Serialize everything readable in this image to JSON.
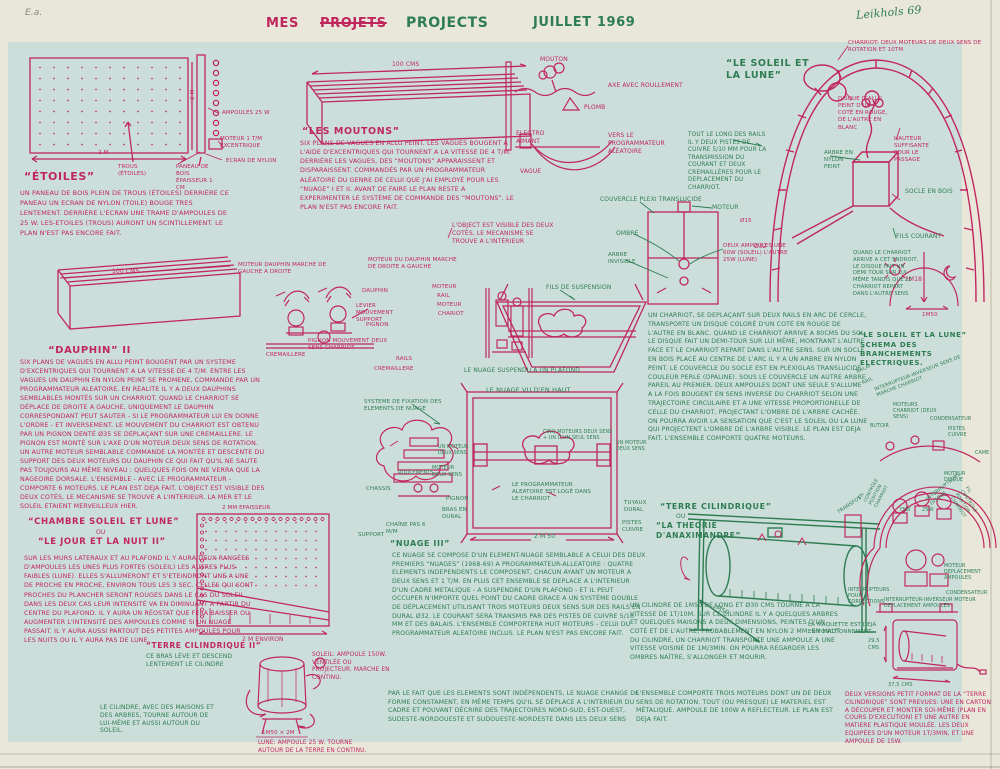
{
  "colors": {
    "red": "#c0275e",
    "green": "#2e7d52",
    "paper": "#e9e6da",
    "field": "#ccdeda"
  },
  "hdr": {
    "ea": "E.a.",
    "mes": "MES",
    "projets": "PROJETS",
    "projects": "PROJECTS",
    "date": "JUILLET 1969",
    "sig": "Leikhols 69"
  },
  "et": {
    "t": "“ÉTOILES”",
    "w": "2 M",
    "h": "2 M",
    "trous": "TROUS (ÉTOILES)",
    "amp": "AMPOULES 25 W",
    "mot": "MOTEUR 1 T/M EXCENTRIQUE",
    "ecr": "ECRAN DE NYLON",
    "pan": "PANEAU DE BOIS ÉPAISSEUR 1 CM",
    "b": "UN PANEAU DE BOIS PLEIN DE TROUS (ÉTOILES) DERRIÈRE CE PANEAU UN ECRAN DE NYLON (TOILE) BOUGE TRES LENTEMENT. DERRIÈRE L'ECRAN UNE TRAME D'AMPOULES DE 25 W. LES-ETOILES (TROUS) AURONT UN SCINTILLEMENT. LE PLAN N'EST PAS ENCORE FAIT."
  },
  "mo": {
    "dim": "100 CMS",
    "t": "“LES MOUTONS”",
    "b": "SIX PLANS DE VAGUES EN ALLU PEINT. LES VAGUES BOUGENT A L'AIDE D'EXCENTRIQUES QUI TOURNENT A LA VITESSE DE 4 T/M. DERRIÈRE LES VAGUES, DES “MOUTONS” APPARAISSENT ET DISPARAISSENT. COMMANDÉS PAR UN PROGRAMMATEUR ALÉATOIRE DU GENRE DE CELUI QUE J'AI EMPLOYÉ POUR LES “NUAGE” I ET II. AVANT DE FAIRE LE PLAN RESTE A EXPERIMENTER LE SYSTÈME DE COMMANDE DES “MOUTONS”. LE PLAN N'EST PAS ENCORE FAIT.",
    "n": "L'OBJECT EST VISIBLE DES DEUX COTÉS, LE MECANISME SE TROUVE A L'INTÉRIEUR"
  },
  "ms": {
    "mouton": "MOUTON",
    "axe": "AXE AVEC ROULLEMENT",
    "plomb": "PLOMB",
    "ea": "ELECTRO AIMANT",
    "vague": "VAGUE",
    "vers": "VERS LE PROGRAMMATEUR ALÉATOIRE"
  },
  "sl": {
    "t": "“LE SOLEIL ET LA LUNE”",
    "char": "CHARRIOT: DEUX MOTEURS DE DEUX SENS DE ROTATION ET 10TM",
    "disq": "DISQUE D'ALLU PEINT D'UN COTÉ EN ROUGE, DE L'AUTRE EN BLANC",
    "haut": "HAUTEUR SUFFISANTE POUR LE PASSAGE",
    "arbre": "ARBRE EN NYLON PEINT",
    "socle": "SOCLE EN BOIS",
    "fils": "FILS COURANT",
    "d1": "Ø15",
    "d2": "Ø32",
    "h": "2M18",
    "w": "1M50",
    "rails": "TOUT LE LONG DES RAILS IL Y DEUX PISTES DE CUIVRE 5/10 MM POUR LA TRANSMISSION DU COURANT ET DEUX CREMAILLÈRES POUR LE DEPLACEMENT DU CHARRIOT.",
    "quand": "QUAND LE CHARRIOT ARRIVE A CET ENDROIT, LE DISQUE FAIT UN DEMI TOUR SUR LUI-MÊME TANDIS QUE LE CHARRIOT REPART DANS L'AUTRE SENS"
  },
  "cv": {
    "couv": "COUVERCLE PLEXI TRANSLUCIDE",
    "mot": "MOTEUR",
    "omb": "OMBRE",
    "arb": "ARBRE INVISIBLE",
    "amp": "DEUX AMPOULES UNE 60W (SOLEIL) L'AUTRE 25W (LUNE)"
  },
  "da": {
    "dim": "100 CMS",
    "mg": "MOTEUR DAUPHIN MARCHE DE GAUCHE A DROITE",
    "md": "MOTEUR DU DAUPHIN MARCHE DE DROITE A GAUCHE",
    "t": "“DAUPHIN” II",
    "b": "SIX PLANS DE VAGUES EN ALLU PEINT BOUGENT PAR UN SYSTEME D'EXCENTRIQUES QUI TOURNENT A LA VITESSE DE 4 T/M. ENTRE LES VAGUES UN DAUPHIN EN NYLON PEINT SE PROMENE, COMMANDE PAR UN PROGRAMMATEUR ALEATOIRE. EN REALITE IL Y A DEUX DAUPHINS SEMBLABLES MONTÉS SUR UN CHARRIOT. QUAND LE CHARRIOT SE DÉPLACE DE DROITE A GAUCHE, UNIQUEMENT LE DAUPHIN CORRESPONDANT PEUT SAUTER - SI LE PROGRAMMATEUR LUI EN DONNE L'ORDRE - ET INVERSEMENT. LE MOUVEMENT DU CHARRIOT EST OBTENU PAR UN PIGNON DENTÉ Ø35 SE DÉPLAÇANT SUR UNE CREMAILLERE. LE PIGNON EST MONTÉ SUR L'AXE D'UN MOTEUR DEUX SENS DE ROTATION. UN AUTRE MOTEUR SEMBLABLE COMMANDE LA MONTÉE ET DESCENTE DU SUPPORT DES DEUX MOTEURS DU DAUPHIN CE QUI FAIT QU'IL NE SAUTE PAS TOUJOURS AU MÊME NIVEAU : QUELQUES FOIS ON NE VERRA QUE LA NAGEOIRE DORSALE. L'ENSEMBLE - AVEC LE PROGRAMMATEUR - COMPORTE 6 MOTEURS. LE PLAN EST DEJA FAIT. L'OBJECT EST VISIBLE DES DEUX COTÉS, LE MECANISME SE TROUVE A L'INTERIEUR. LA MER ET LE SOLEIL ETAIENT MERVEILLEUX HIER."
  },
  "dk": {
    "dauphin": "DAUPHIN",
    "m1": "MOTEUR",
    "rail": "RAIL",
    "m2": "MOTEUR",
    "chariot": "CHARIOT",
    "levier": "LEVIER MOUVEMENT SUPPORT",
    "pignon": "PIGNON",
    "pmc": "PIGNON MOUVEMENT DEUX SENS CHARRIOT",
    "crem1": "CREMAILLERE",
    "rails": "RAILS",
    "crem2": "CREMAILLERE"
  },
  "nu": {
    "fils": "FILS DE SUSPENSION",
    "plafond": "LE NUAGE SUSPENDU A UN PLAFOND",
    "haut": "LE NUAGE VU D'EN HAUT",
    "sys": "SYSTEME DE FIXATION DES ELEMENTS DE NUAGE",
    "m1": "UN MOTEUR DEUX SENS",
    "cinq": "CINQ MOTEURS DEUX SENS + UN D'UN SEUL SENS",
    "m2": "UN MOTEUR DEUX SENS",
    "roul": "ROULEMENTS",
    "mds": "MOTEUR DEUX SENS",
    "pig": "PIGNON",
    "bras": "BRAS EN DURAL",
    "chaine": "CHAÎNE PAS 6 M/M",
    "chassis": "CHASSIS",
    "support": "SUPPORT",
    "prog": "LE PROGRAMMATEUR ALEATOIRE EST LOGÉ DANS LE CHARRIOT",
    "tuy": "TUYAUX DURAL",
    "pistes": "PISTES CUIVRE",
    "dim": "2 M 50"
  },
  "arc": {
    "b": "UN CHARRIOT, SE DEPLAÇANT SUR DEUX RAILS EN ARC DE CERCLE, TRANSPORTE UN DISQUE COLORÉ D'UN COTÉ EN ROUGE DE L'AUTRE EN BLANC. QUAND LE CHARRIOT ARRIVE A 80CMS DU SOL, LE DISQUE FAIT UN DEMI-TOUR SUR LUI MÊME, MONTRANT L'AUTRE FACE ET LE CHARRIOT REPART DANS L'AUTRE SENS. SUR UN SOCLE EN BOIS PLACÉ AU CENTRE DE L'ARC IL Y A UN ARBRE EN NYLON PEINT. LE COUVERCLE DU SOCLE EST EN PLEXIGLAS TRANSLUCIDE COULEUR PERLE (OPALINE). SOUS LE COUVERCLE UN AUTRE ARBRE PAREIL AU PREMIER. DEUX AMPOULES DONT UNE SEULE S'ALLUME A LA FOIS BOUGENT EN SENS INVERSE DU CHARRIOT SELON UNE TRAJECTOIRE CIRCULAIRE ET A UNE VITESSE PROPORTIONELLE DE CELLE DU CHARRIOT, PROJECTANT L'OMBRE DE L'ARBRE CACHÉE. ON POURRA AVOIR LA SENSATION QUE C'EST LE SOLEIL OU LA LUNE QUI PROJECTENT L'OMBRE DE L'ARBRE VISIBLE. LE PLAN EST DEJA FAIT. L'ENSEMBLE COMPORTE QUATRE MOTEURS."
  },
  "sch": {
    "t1": "“LE SOLEIL ET LA LUNE”",
    "t2": "SCHEMA DES BRANCHEMENTS ELECTRIQUES.",
    "balai": "BALAI",
    "rail": "RAIL",
    "inv": "INTERRUPTEUR-INVERSEUR SENS DE MARCHE CHARRIOT",
    "motc": "MOTEURS CHARRIOT (DEUX SENS)",
    "but": "BUTOIR",
    "cond": "CONDENSATEUR",
    "pistes": "PISTES CUIVRE",
    "came": "CAME",
    "motd": "MOTEUR DISQUE",
    "intd": "INTERRUPTEURS DISQUE",
    "w75": "75W",
    "w25": "25W",
    "filg": "FIL CONTRÔLE POSITION CHARRIOT",
    "fild": "FIL CONTRÔLE POSITION CHARRIOT",
    "motda": "MOTEUR DEPLACEMENT AMPOULES",
    "cond2": "CONDENSATEUR",
    "inv2": "INTERRUPTEUR-INVERSEUR MOTEUR DEPLACEMENT AMPOULES",
    "intc": "INTERRUPTEURS POUR CORRECTIONS",
    "trans": "TRANSFOS"
  },
  "ch": {
    "t1": "“CHAMBRE SOLEIL ET LUNE”",
    "ou": "OU",
    "t2": "“LE JOUR ET LA NUIT II”",
    "b": "SUR LES MURS LATERAUX ET AU PLAFOND IL Y AURA DEUX RANGÉES D'AMPOULES LES UNES PLUS FORTES (SOLEIL) LES AUTRES PLUS FAIBLES (LUNE). ELLES S'ALLUMERONT ET S'ETEINDRONT UNE A UNE DE PROCHE EN PROCHE, ENVIRON TOUS LES 3 SEC. CELLES QUI SONT PROCHES DU PLANCHER SERONT ROUGES DANS LE CAS DU SOLEIL. DANS LES DEUX CAS LEUR INTENSITÉ VA EN DIMINUANT A PARTIR DU CENTRE DU PLAFOND. IL Y AURA UN RÉOSTAT QUE FERA BAISSER OU AUGMENTER L'INTENSITÉ DES AMPOULES COMME SI UN NUAGE PASSAIT. IL Y AURA AUSSI PARTOUT DES PETITES AMPOULES POUR LES NUITS OU IL Y AURA PAS DE LUNE."
  },
  "n3": {
    "t": "“NUAGE III”",
    "b": "CE NUAGE SE COMPOSE D'UN ELEMENT-NUAGE SEMBLABLE A CELUI DES DEUX PREMIERS “NUAGES” (1968-69) A PROGRAMMATEUR-ALLEATOIRE : QUATRE ELEMENTS INDEPENDENTS LE COMPOSENT, CHACUN AYANT UN MOTEUR A DEUX SENS ET 1 T/M. EN PLUS CET ENSEMBLE SE DEPLACE A L'INTERIEUR D'UN CADRE METALIQUE - A SUSPENDRE D'UN PLAFOND - ET IL PEUT OCCUPER N'IMPORTE QUEL POINT DU CADRE GRACE A UN SYSTÈME DOUBLE DE DÉPLACEMENT UTILISANT TROIS MOTEURS DEUX SENS SUR DES RAILS EN DURAL Ø32. LE COURANT SERA TRANSMIS PAR DES PISTES DE CUIVRE 5/10 MM ET DES BALAIS. L'ENSEMBLE COMPORTERA HUIT MOTEURS - CELUI DU PROGRAMMATEUR ALEATOIRE INCLUS. LE PLAN N'EST PAS ENCORE FAIT.",
    "b2": "PAR LE FAIT QUE LES ELEMENTS SONT INDÉPENDENTS, LE NUAGE CHANGE DE FORME CONSTAMENT, EN MÊME TEMPS QU'IL SE DÉPLACE A L'INTERIEUR DU CADRE ET POUVANT DÉCRIRE DES TRAJECTOIRES NORD-SUD, EST-OUEST, SUDESTE-NORDOUESTE ET SUDOUESTE-NORDESTE DANS LES DEUX SENS"
  },
  "tc": {
    "t1": "“TERRE CILINDRIQUE”",
    "ou": "OU",
    "t2": "“LA THEORIE D'ANAXIMANDRE”",
    "dim": "1M50",
    "b": "UN CILINDRE DE 1M50 DE LONG ET Ø30 CMS TOURNE A LA VITESSE DE 1T/10M. SUR CE CILINDRE IL Y A QUELQUES ARBRES ET QUELQUES MAISONS A DEUX DIMENSIONS, PEINTES D'UN COTÉ ET DE L'AUTRE, PROBABLEMENT EN NYLON 2 MM. EN HAUT DU CILINDRE, UN CHARRIOT TRANSPORTE UNE AMPOULE A UNE VITESSE VOISINE DE 1M/3MIN. ON POURRA REGARDER LES OMBRES NAÎTRE, S'ALLONGER ET MOURIR.",
    "b2": "L'ENSEMBLE COMPORTE TROIS MOTEURS DONT UN DE DEUX SENS DE ROTATION. TOUT (OU PRESQUE) LE MATERIEL EST MÉTALIQUE. AMPOULE DE 100W A REFLECTEUR. LE PLAN EST DEJA FAIT."
  },
  "t2": {
    "ep": "2 MM EPAISSEUR",
    "env": "2 M ENVIRON",
    "t": "“TERRE CILINDRIQUE II”",
    "bras": "CE BRAS LÈVE ET DESCEND LENTEMENT LE CILINDRE",
    "soleil": "SOLEIL: AMPOULE 150W. VENTILÉE OU PROJECTEUR. MARCHE EN CONTINU.",
    "cil": "LE CILINDRE, AVEC DES MAISONS ET DES ARBRES, TOURNE AUTOUR DE LUI-MÊME ET AUSSI AUTOUR DU SOLEIL.",
    "dim": "1M50 × 2M",
    "lune": "LUNE: AMPOULE 25 W. TOURNE AUTOUR DE LA TERRE EN CONTINU."
  },
  "mq": {
    "b": "LA MAQUETTE EST DEJA EN FONCTIONNEMENT",
    "h": "29,5 CMS",
    "w": "37,5 CMS"
  },
  "vr": {
    "b": "DEUX VERSIONS PETIT FORMAT DE LA “TERRE CILINDRIQUE” SONT PREVUES: UNE EN CARTON A DÉCOUPER ET MONTER SOI-MÊME (PLAN EN COURS D'EXECUTION) ET UNE AUTRE EN MATIERE PLASTIQUE MOULÉE. LES DEUX EQUIPÉES D'UN MOTEUR 1T/3MIN, ET UNE AMPOULE DE 15W."
  }
}
